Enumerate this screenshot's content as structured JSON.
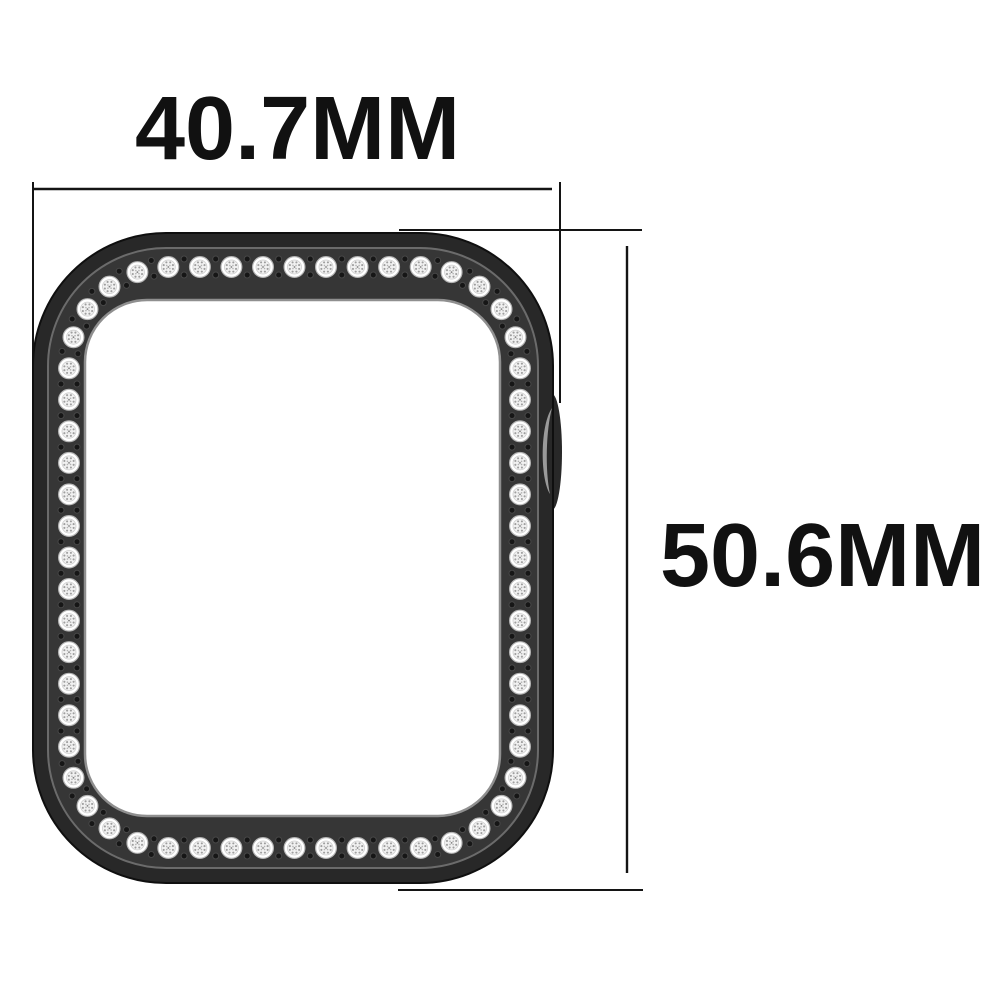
{
  "annotations": {
    "width_label": "40.7MM",
    "height_label": "50.6MM"
  },
  "illustration": {
    "subject": "black smartwatch protective case studded with rhinestones, top view",
    "rhinestone_count": 60,
    "spacer_dots_per_gap": 2
  },
  "colors": {
    "background": "#ffffff",
    "case_dark": "#282828",
    "case_face": "#363636",
    "bevel_highlight": "#6b6b6b",
    "inner_ring": "#8f8f8f",
    "notch_highlight": "#9a9a9a",
    "stone_white": "#ffffff",
    "stone_mid": "#f1f1f1",
    "stone_edge": "#b5b5b5",
    "stone_inner_edge": "#cfcfcf",
    "stone_facet": "#8a8a8a",
    "dot_fill": "#161616",
    "dot_ring": "#474747",
    "line_color": "#141414",
    "text_color": "#111111"
  }
}
